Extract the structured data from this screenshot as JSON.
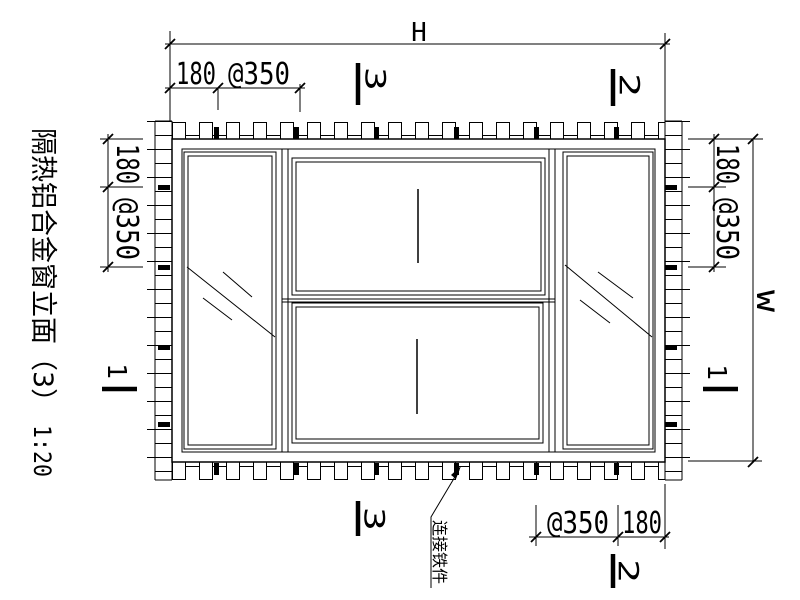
{
  "drawing": {
    "title": "隔热铝合金窗立面（3）",
    "scale": "1:20",
    "background_color": "#ffffff",
    "line_color": "#000000"
  },
  "dimensions": {
    "width_label": "H",
    "height_label": "W",
    "top": {
      "edge": "180",
      "spacing": "@350"
    },
    "left": {
      "edge": "180",
      "spacing": "@350"
    },
    "right": {
      "edge": "180",
      "spacing": "@350"
    },
    "bottom": {
      "spacing": "@350",
      "edge": "180"
    }
  },
  "section_markers": {
    "s1": "1",
    "s2": "2",
    "s3": "3"
  },
  "annotations": {
    "anchor_label": "连接铁件"
  }
}
